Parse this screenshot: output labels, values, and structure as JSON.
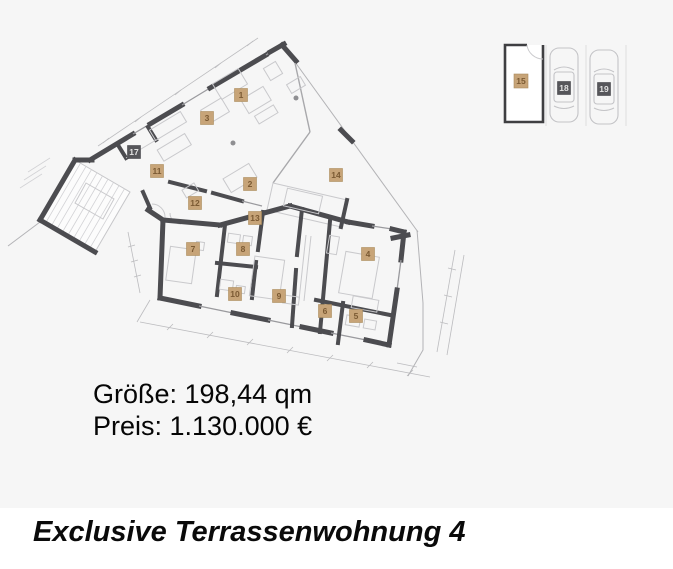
{
  "page": {
    "background_color": "#f6f6f6",
    "footer_background_color": "#ffffff"
  },
  "floor_plan": {
    "description": "apartment-floor-plan",
    "wall_color": "#4c4c50",
    "label_colors": {
      "beige_bg": "#c7a478",
      "beige_text": "#7b5a33",
      "dark_bg": "#56565a",
      "dark_text": "#e3e3e3"
    },
    "room_labels": {
      "r1": "1",
      "r2": "2",
      "r3": "3",
      "r4": "4",
      "r5": "5",
      "r6": "6",
      "r7": "7",
      "r8": "8",
      "r9": "9",
      "r10": "10",
      "r11": "11",
      "r12": "12",
      "r13": "13",
      "r14": "14",
      "r17": "17"
    }
  },
  "parking": {
    "garage_label": "15",
    "space_labels": {
      "s18": "18",
      "s19": "19"
    }
  },
  "details": {
    "size_line": "Größe: 198,44 qm",
    "price_line": "Preis: 1.130.000 €"
  },
  "footer": {
    "title": "Exclusive Terrassenwohnung 4"
  }
}
